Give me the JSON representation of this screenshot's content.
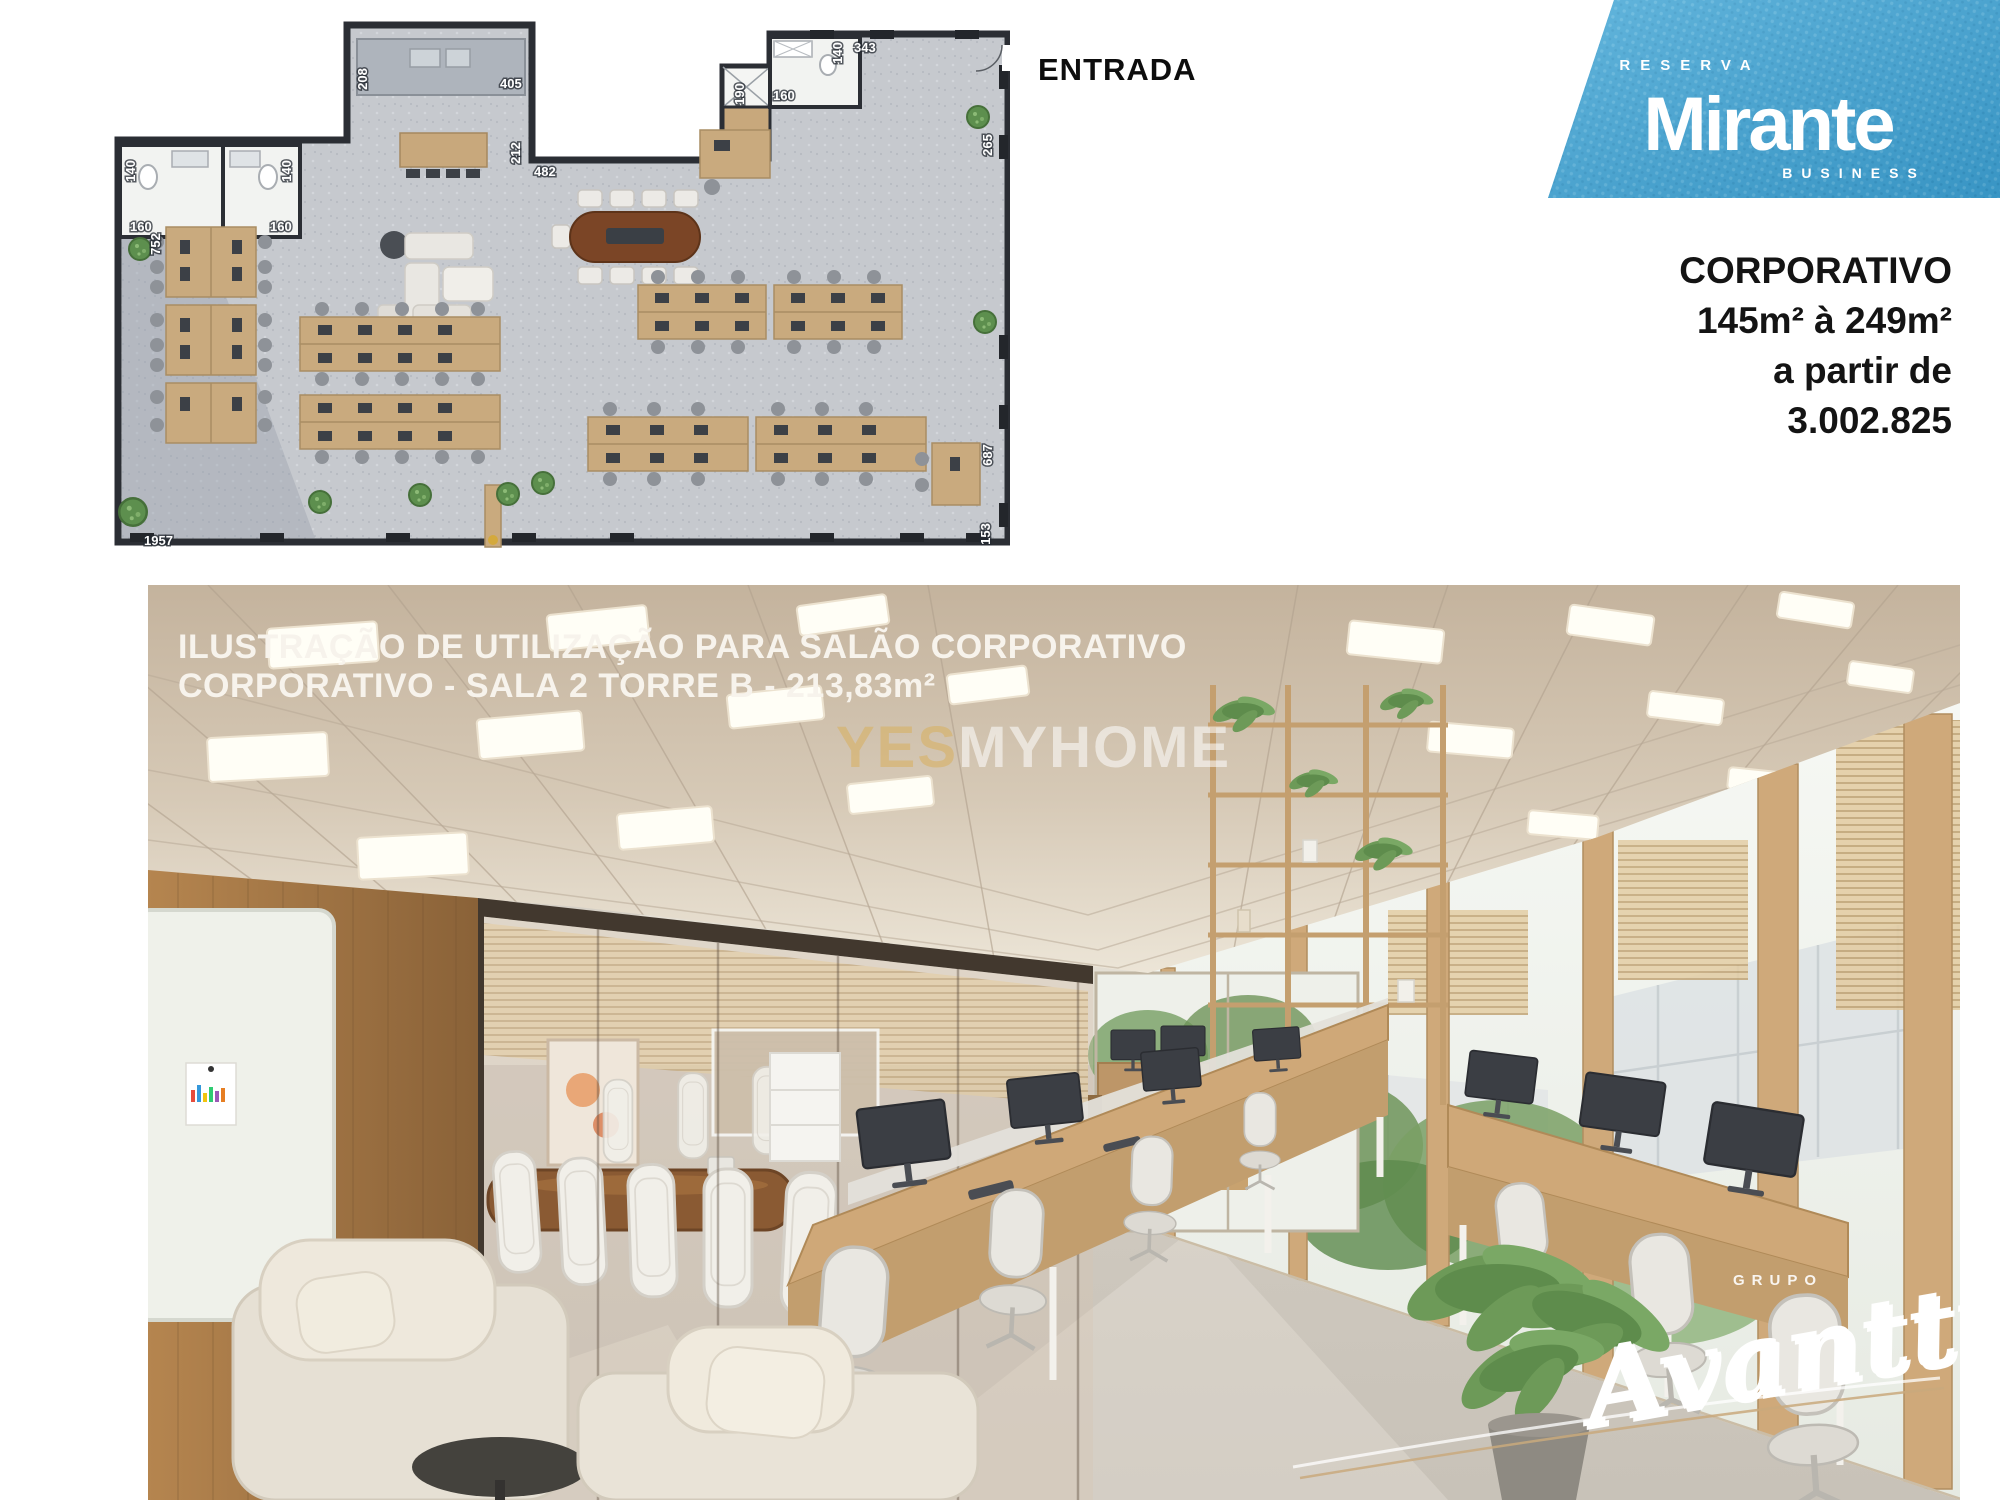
{
  "floor_plan": {
    "entrance_label": "ENTRADA",
    "dims": [
      "208",
      "405",
      "212",
      "482",
      "190",
      "160",
      "140",
      "343",
      "140",
      "160",
      "140",
      "160",
      "265",
      "687",
      "153",
      "752",
      "1957"
    ]
  },
  "logo": {
    "line1": "RESERVA",
    "line2": "Mirante",
    "line3": "BUSINESS",
    "bg_color": "#45a3d1"
  },
  "offer": {
    "title": "CORPORATIVO",
    "area_range": "145m² à 249m²",
    "prefix": "a partir de",
    "price": "3.002.825"
  },
  "photo": {
    "caption_line1": "ILUSTRAÇÃO DE UTILIZAÇÃO PARA  SALÃO CORPORATIVO",
    "caption_line2": "CORPORATIVO - SALA 2 TORRE B - 213,83m²",
    "watermark_part1": "YES",
    "watermark_part2": "MYHOME",
    "watermark_color1": "#d9b05e",
    "watermark_color2": "#ffffff",
    "signature_small": "GRUPO",
    "signature_script": "Avantti"
  }
}
